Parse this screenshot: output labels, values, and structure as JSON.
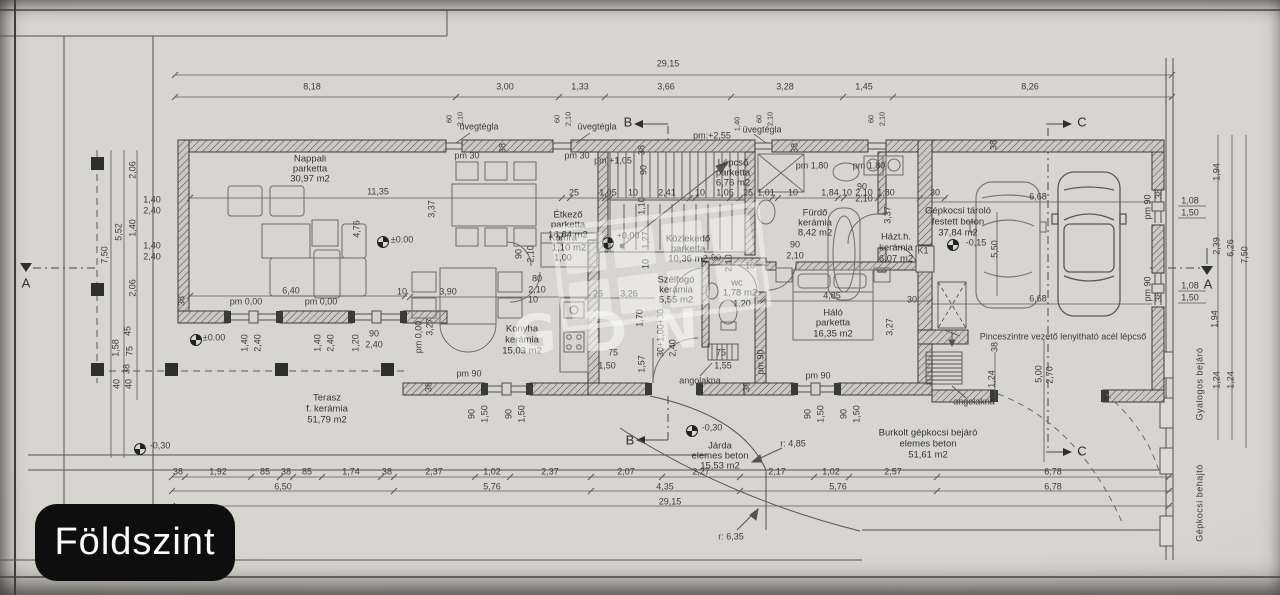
{
  "badge": {
    "label": "Földszint"
  },
  "watermark": {
    "letters": "GDN"
  },
  "rooms": {
    "nappali": {
      "name": "Nappali",
      "mat": "parketta",
      "area": "30,97 m2"
    },
    "etkezo": {
      "name": "Étkező",
      "mat": "parketta",
      "area": "16,64 m2"
    },
    "lepcso": {
      "name": "Lépcső",
      "mat": "parketta",
      "area": "6,76 m2"
    },
    "kozlekedo": {
      "name": "Közlekedő",
      "mat": "parketta",
      "area": "10,36 m2"
    },
    "kamra": {
      "name": "Kamra",
      "area": "1,10 m2",
      "extra": "1,00"
    },
    "szelfogo": {
      "name": "Szélfogó",
      "mat": "kerámia",
      "area": "5,55 m2"
    },
    "wc": {
      "name": "wc",
      "area": "1,78 m2",
      "extra": "1,20"
    },
    "furdo": {
      "name": "Fürdő",
      "mat": "kerámia",
      "area": "8,42 m2"
    },
    "hazth": {
      "name": "Házt.h.",
      "mat": "kerámia",
      "area": "6,07 m2"
    },
    "halo": {
      "name": "Háló",
      "mat": "parketta",
      "area": "16,35 m2"
    },
    "konyha": {
      "name": "Konyha",
      "mat": "kerámia",
      "area": "15,03 m2"
    },
    "terasz": {
      "name": "Terasz",
      "mat": "f. kerámia",
      "area": "51,79 m2"
    },
    "garazs": {
      "name": "Gépkocsi tároló",
      "mat": "festett beton",
      "area": "37,84 m2",
      "level": "-0,15"
    },
    "jarda": {
      "name": "Járda",
      "mat": "elemes beton",
      "area": "15,53 m2"
    },
    "behajto": {
      "name": "Burkolt gépkocsi bejáró",
      "mat": "elemes beton",
      "area": "51,61 m2"
    }
  },
  "notes": {
    "uvegtegla": "üvegtégla",
    "pinceszint": "Pinceszintre vezető lenyitható acél lépcső",
    "angolakna": "angolakna",
    "gyalogos": "Gyalogos bejáró",
    "gepkocsi": "Gépkocsi behajtó",
    "k1": "K1",
    "r485": "r: 4,85",
    "r635": "r: 6,35"
  },
  "levels": {
    "pm30": "pm 30",
    "pm105": "pm:+1,05",
    "pm255": "pm:+2,55",
    "pm180": "pm 1,80",
    "pm90": "pm 90",
    "pm000": "pm 0,00",
    "zero": "±0.00",
    "plus": "+0,00",
    "m030": "-0,30"
  },
  "markers": {
    "a": "A",
    "b": "B",
    "c": "C"
  },
  "d": {
    "n10": "10",
    "n25": "25",
    "n30": "30",
    "n38": "38",
    "n40": "40",
    "n45": "45",
    "n60": "60",
    "n75": "75",
    "n80": "80",
    "n85": "85",
    "n90": "90",
    "n100": "1,00",
    "n101": "1,01",
    "n102": "1,02",
    "n105": "1,05",
    "n108": "1,08",
    "n110": "1,10",
    "n120": "1,20",
    "n124": "1,24",
    "n127": "1,27",
    "n133": "1,33",
    "n140": "1,40",
    "n145": "1,45",
    "n150": "1,50",
    "n155": "1,55",
    "n157": "1,57",
    "n158": "1,58",
    "n170": "1,70",
    "n174": "1,74",
    "n180": "1,80",
    "n184": "1,84",
    "n192": "1,92",
    "n194": "1,94",
    "n206": "2,06",
    "n207": "2,07",
    "n210": "2,10",
    "n217": "2,17",
    "n227": "2,27",
    "n237": "2,37",
    "n239": "2,39",
    "n240": "2,40",
    "n241": "2,41",
    "n257": "2,57",
    "n270": "2,70",
    "n300": "3,00",
    "n326": "3,26",
    "n327": "3,27",
    "n328": "3,28",
    "n337": "3,37",
    "n366": "3,66",
    "n390": "3,90",
    "n435": "4,35",
    "n476": "4,76",
    "n485": "4,85",
    "n500": "5,00",
    "n550": "5,50",
    "n552": "5,52",
    "n576": "5,76",
    "n626": "6,26",
    "n640": "6,40",
    "n650": "6,50",
    "n668": "6,68",
    "n678": "6,78",
    "n750": "7,50",
    "n818": "8,18",
    "n826": "8,26",
    "n1135": "11,35",
    "n2915": "29,15",
    "sum": "30+1,00+30"
  }
}
